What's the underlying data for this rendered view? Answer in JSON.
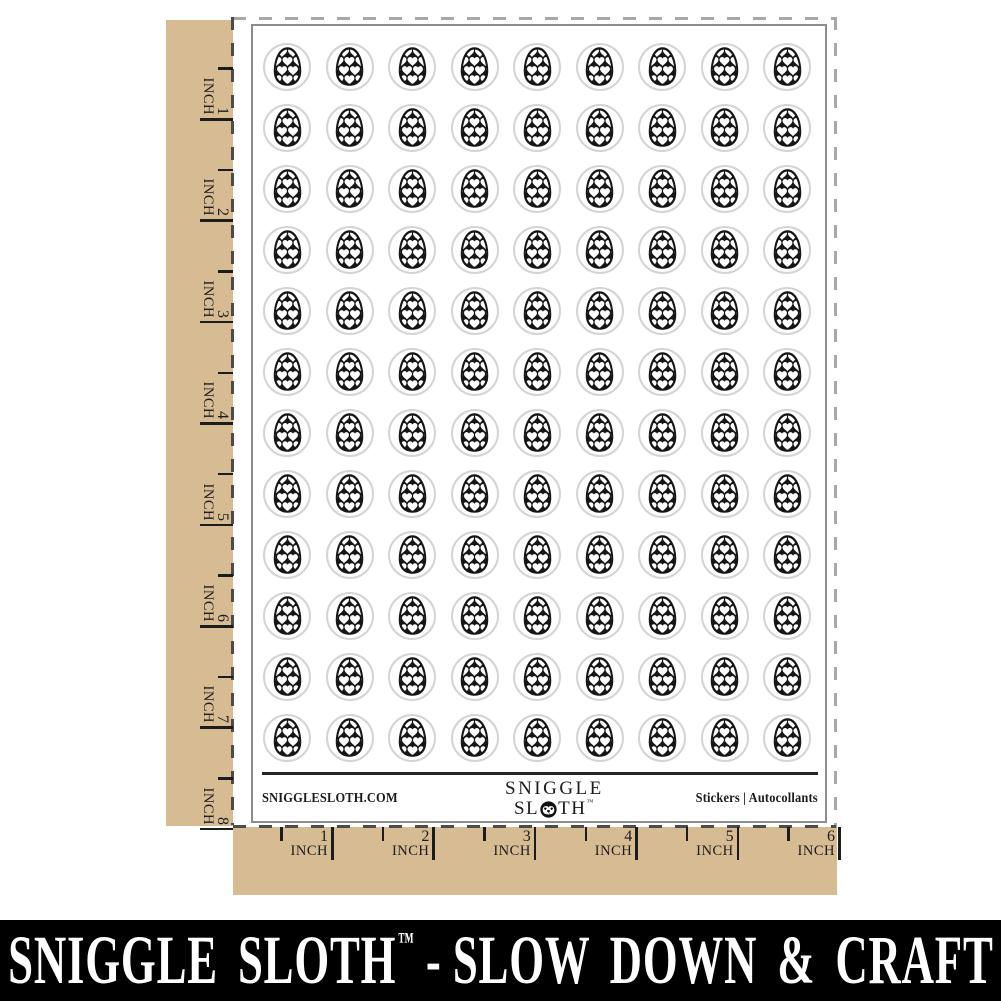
{
  "sheet": {
    "website": "SNIGGLESLOTH.COM",
    "logo": {
      "line1": "SNIGGLE",
      "line2_pre": "SL",
      "line2_post": "TH",
      "tm": "™"
    },
    "right_label": "Stickers  |  Autocollants"
  },
  "grid": {
    "rows": 12,
    "columns": 9,
    "sticker_count": 108,
    "sticker_design": "easter-egg-with-white-hearts"
  },
  "rulers": {
    "unit": "INCH",
    "left_numbers": [
      1,
      2,
      3,
      4,
      5,
      6,
      7,
      8
    ],
    "bottom_numbers": [
      1,
      2,
      3,
      4,
      5,
      6
    ]
  },
  "banner": {
    "brand": "SNIGGLE SLOTH",
    "tm": "™",
    "separator": "-",
    "tagline": "SLOW DOWN & CRAFT"
  },
  "colors": {
    "kraft": "#d7bb92",
    "egg": "#161616",
    "ink": "#1c1c1c",
    "sheet_border": "#8d8d8d",
    "sticker_outline": "#d4d4d4",
    "cut_line_light": "#a8a8a8",
    "cut_line_dark": "#4c4c4c",
    "banner_bg": "#000000",
    "banner_text": "#ffffff"
  }
}
